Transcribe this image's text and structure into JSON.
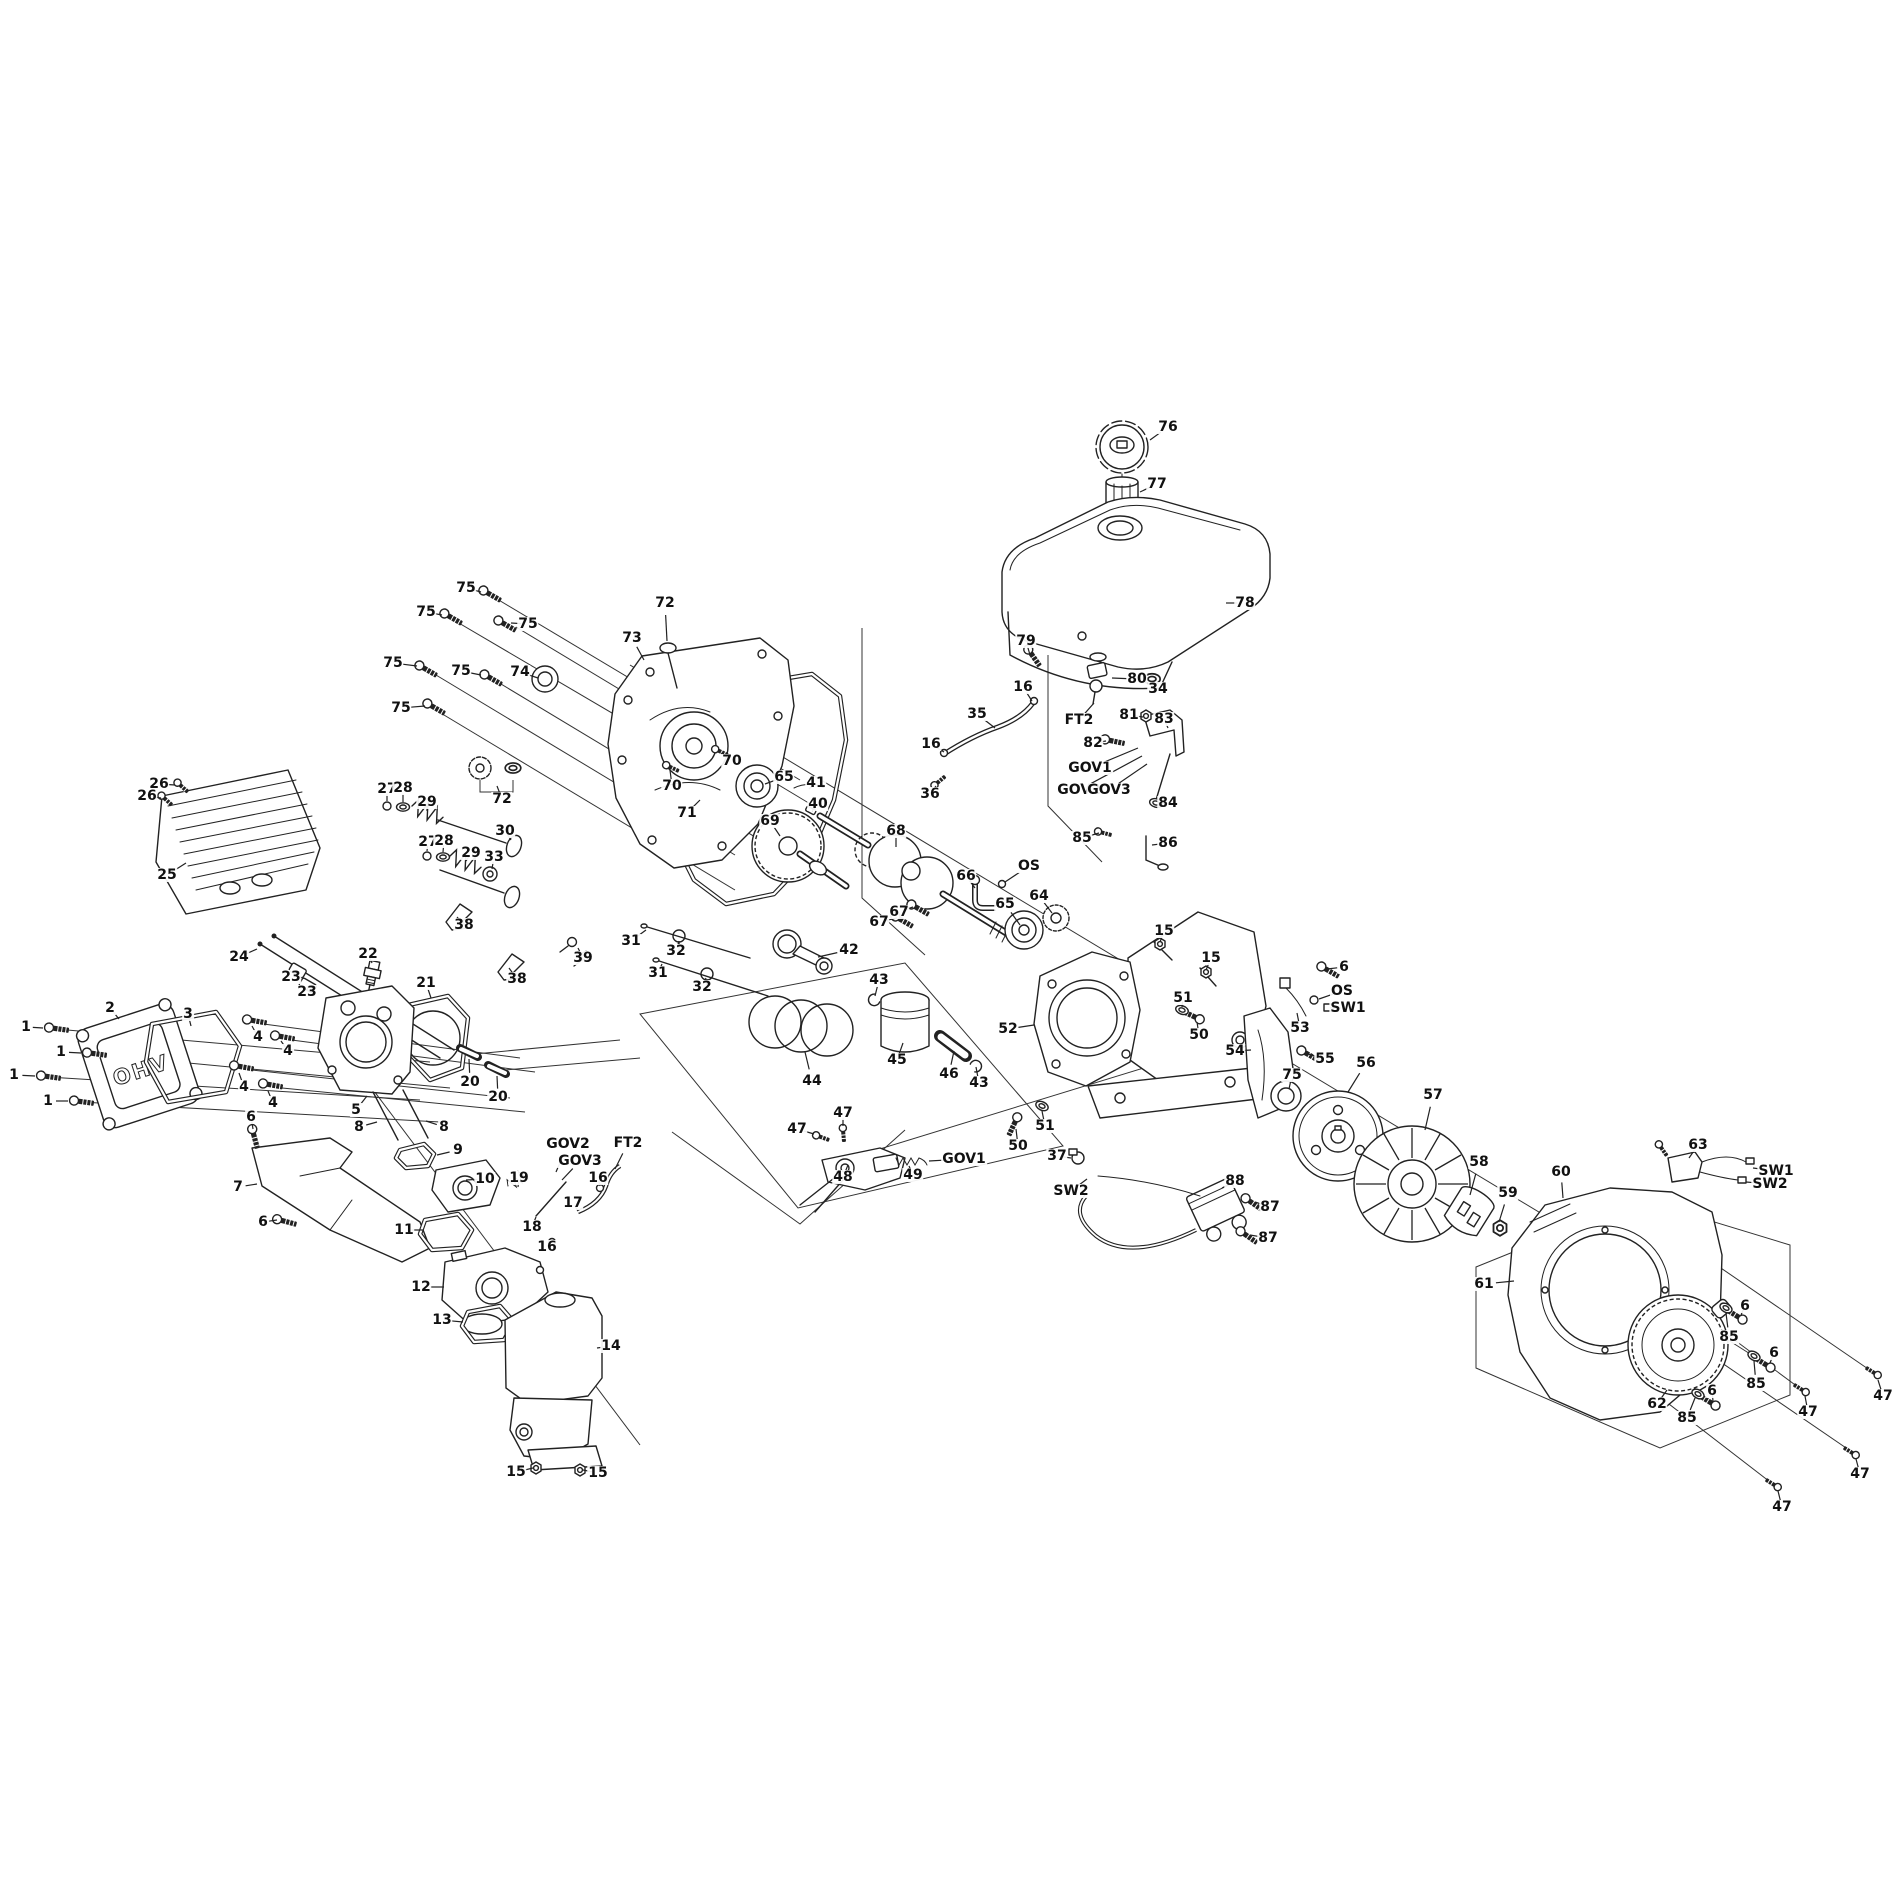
{
  "diagram": {
    "type": "exploded-parts-diagram",
    "subject": "small OHV engine",
    "background": "#ffffff",
    "line_color": "#222222",
    "ohv_text": "OHV",
    "callouts": [
      {
        "t": "76",
        "x": 1168,
        "y": 427,
        "u": 1150,
        "v": 440
      },
      {
        "t": "77",
        "x": 1157,
        "y": 484,
        "u": 1140,
        "v": 492
      },
      {
        "t": "78",
        "x": 1245,
        "y": 603,
        "u": 1226,
        "v": 603
      },
      {
        "t": "79",
        "x": 1026,
        "y": 641,
        "u": 1030,
        "v": 655
      },
      {
        "t": "16",
        "x": 1023,
        "y": 687,
        "u": 1032,
        "v": 701
      },
      {
        "t": "35",
        "x": 977,
        "y": 714,
        "u": 995,
        "v": 728
      },
      {
        "t": "16",
        "x": 931,
        "y": 744,
        "u": 944,
        "v": 752
      },
      {
        "t": "36",
        "x": 930,
        "y": 794,
        "u": 936,
        "v": 786
      },
      {
        "t": "80",
        "x": 1137,
        "y": 679,
        "u": 1112,
        "v": 678
      },
      {
        "t": "34",
        "x": 1158,
        "y": 689,
        "u": 1152,
        "v": 681
      },
      {
        "t": "FT2",
        "x": 1079,
        "y": 720,
        "u": 1094,
        "v": 703
      },
      {
        "t": "81",
        "x": 1129,
        "y": 715,
        "u": 1143,
        "v": 717
      },
      {
        "t": "83",
        "x": 1164,
        "y": 719,
        "u": 1168,
        "v": 728
      },
      {
        "t": "82",
        "x": 1093,
        "y": 743,
        "u": 1106,
        "v": 741
      },
      {
        "t": "GOV1",
        "x": 1090,
        "y": 768,
        "u": 1138,
        "v": 748
      },
      {
        "t": "GOV2",
        "x": 1079,
        "y": 790,
        "u": 1142,
        "v": 756
      },
      {
        "t": "GOV3",
        "x": 1109,
        "y": 790,
        "u": 1147,
        "v": 764
      },
      {
        "t": "84",
        "x": 1168,
        "y": 803,
        "u": 1159,
        "v": 803
      },
      {
        "t": "85",
        "x": 1082,
        "y": 838,
        "u": 1099,
        "v": 833
      },
      {
        "t": "86",
        "x": 1168,
        "y": 843,
        "u": 1152,
        "v": 845
      },
      {
        "t": "75",
        "x": 466,
        "y": 588,
        "u": 481,
        "v": 592
      },
      {
        "t": "75",
        "x": 426,
        "y": 612,
        "u": 442,
        "v": 615
      },
      {
        "t": "75",
        "x": 528,
        "y": 624,
        "u": 511,
        "v": 623
      },
      {
        "t": "75",
        "x": 393,
        "y": 663,
        "u": 417,
        "v": 666
      },
      {
        "t": "75",
        "x": 461,
        "y": 671,
        "u": 481,
        "v": 675
      },
      {
        "t": "75",
        "x": 401,
        "y": 708,
        "u": 425,
        "v": 706
      },
      {
        "t": "74",
        "x": 520,
        "y": 672,
        "u": 538,
        "v": 678
      },
      {
        "t": "72",
        "x": 665,
        "y": 603,
        "u": 667,
        "v": 641
      },
      {
        "t": "73",
        "x": 632,
        "y": 638,
        "u": 644,
        "v": 660
      },
      {
        "t": "70",
        "x": 732,
        "y": 761,
        "u": 721,
        "v": 753
      },
      {
        "t": "70",
        "x": 672,
        "y": 786,
        "u": 670,
        "v": 770
      },
      {
        "t": "71",
        "x": 687,
        "y": 813,
        "u": 700,
        "v": 800
      },
      {
        "t": "72",
        "x": 502,
        "y": 799,
        "u": 497,
        "v": 786
      },
      {
        "t": "65",
        "x": 784,
        "y": 777,
        "u": 765,
        "v": 784
      },
      {
        "t": "69",
        "x": 770,
        "y": 821,
        "u": 780,
        "v": 836
      },
      {
        "t": "41",
        "x": 816,
        "y": 783,
        "u": 809,
        "v": 789
      },
      {
        "t": "40",
        "x": 818,
        "y": 804,
        "u": 812,
        "v": 811
      },
      {
        "t": "68",
        "x": 896,
        "y": 831,
        "u": 896,
        "v": 847
      },
      {
        "t": "66",
        "x": 966,
        "y": 876,
        "u": 975,
        "v": 888
      },
      {
        "t": "OS",
        "x": 1029,
        "y": 866,
        "u": 1005,
        "v": 882
      },
      {
        "t": "67",
        "x": 899,
        "y": 912,
        "u": 913,
        "v": 907
      },
      {
        "t": "67",
        "x": 879,
        "y": 922,
        "u": 897,
        "v": 918
      },
      {
        "t": "65",
        "x": 1005,
        "y": 904,
        "u": 1020,
        "v": 925
      },
      {
        "t": "64",
        "x": 1039,
        "y": 896,
        "u": 1052,
        "v": 913
      },
      {
        "t": "31",
        "x": 631,
        "y": 941,
        "u": 646,
        "v": 930
      },
      {
        "t": "32",
        "x": 676,
        "y": 951,
        "u": 679,
        "v": 941
      },
      {
        "t": "31",
        "x": 658,
        "y": 973,
        "u": 662,
        "v": 964
      },
      {
        "t": "32",
        "x": 702,
        "y": 987,
        "u": 706,
        "v": 978
      },
      {
        "t": "42",
        "x": 849,
        "y": 950,
        "u": 818,
        "v": 957
      },
      {
        "t": "43",
        "x": 879,
        "y": 980,
        "u": 875,
        "v": 996
      },
      {
        "t": "44",
        "x": 812,
        "y": 1081,
        "u": 805,
        "v": 1052
      },
      {
        "t": "45",
        "x": 897,
        "y": 1060,
        "u": 903,
        "v": 1043
      },
      {
        "t": "46",
        "x": 949,
        "y": 1074,
        "u": 954,
        "v": 1051
      },
      {
        "t": "43",
        "x": 979,
        "y": 1083,
        "u": 976,
        "v": 1067
      },
      {
        "t": "52",
        "x": 1008,
        "y": 1029,
        "u": 1034,
        "v": 1025
      },
      {
        "t": "47",
        "x": 843,
        "y": 1113,
        "u": 843,
        "v": 1126
      },
      {
        "t": "47",
        "x": 797,
        "y": 1129,
        "u": 814,
        "v": 1134
      },
      {
        "t": "48",
        "x": 843,
        "y": 1177,
        "u": 848,
        "v": 1165
      },
      {
        "t": "49",
        "x": 913,
        "y": 1175,
        "u": 909,
        "v": 1166
      },
      {
        "t": "GOV1",
        "x": 964,
        "y": 1159,
        "u": 929,
        "v": 1161
      },
      {
        "t": "50",
        "x": 1018,
        "y": 1146,
        "u": 1016,
        "v": 1129
      },
      {
        "t": "51",
        "x": 1045,
        "y": 1126,
        "u": 1042,
        "v": 1111
      },
      {
        "t": "37",
        "x": 1057,
        "y": 1156,
        "u": 1071,
        "v": 1158
      },
      {
        "t": "SW2",
        "x": 1071,
        "y": 1191,
        "u": 1087,
        "v": 1179
      },
      {
        "t": "15",
        "x": 1164,
        "y": 931,
        "u": 1160,
        "v": 942
      },
      {
        "t": "15",
        "x": 1211,
        "y": 958,
        "u": 1206,
        "v": 970
      },
      {
        "t": "51",
        "x": 1183,
        "y": 998,
        "u": 1182,
        "v": 1007
      },
      {
        "t": "50",
        "x": 1199,
        "y": 1035,
        "u": 1197,
        "v": 1022
      },
      {
        "t": "6",
        "x": 1344,
        "y": 967,
        "u": 1327,
        "v": 969
      },
      {
        "t": "OS",
        "x": 1342,
        "y": 991,
        "u": 1319,
        "v": 999
      },
      {
        "t": "SW1",
        "x": 1348,
        "y": 1008,
        "u": 1330,
        "v": 1008
      },
      {
        "t": "53",
        "x": 1300,
        "y": 1028,
        "u": 1297,
        "v": 1013
      },
      {
        "t": "54",
        "x": 1235,
        "y": 1051,
        "u": 1251,
        "v": 1050
      },
      {
        "t": "55",
        "x": 1325,
        "y": 1059,
        "u": 1308,
        "v": 1054
      },
      {
        "t": "75",
        "x": 1292,
        "y": 1075,
        "u": 1289,
        "v": 1089
      },
      {
        "t": "56",
        "x": 1366,
        "y": 1063,
        "u": 1348,
        "v": 1092
      },
      {
        "t": "57",
        "x": 1433,
        "y": 1095,
        "u": 1425,
        "v": 1130
      },
      {
        "t": "58",
        "x": 1479,
        "y": 1162,
        "u": 1470,
        "v": 1195
      },
      {
        "t": "59",
        "x": 1508,
        "y": 1193,
        "u": 1499,
        "v": 1222
      },
      {
        "t": "60",
        "x": 1561,
        "y": 1172,
        "u": 1563,
        "v": 1198
      },
      {
        "t": "61",
        "x": 1484,
        "y": 1284,
        "u": 1514,
        "v": 1281
      },
      {
        "t": "62",
        "x": 1657,
        "y": 1404,
        "u": 1667,
        "v": 1390
      },
      {
        "t": "63",
        "x": 1698,
        "y": 1145,
        "u": 1689,
        "v": 1158
      },
      {
        "t": "SW1",
        "x": 1776,
        "y": 1171,
        "u": 1753,
        "v": 1168
      },
      {
        "t": "SW2",
        "x": 1770,
        "y": 1184,
        "u": 1746,
        "v": 1182
      },
      {
        "t": "6",
        "x": 1745,
        "y": 1306,
        "u": 1741,
        "v": 1315
      },
      {
        "t": "85",
        "x": 1729,
        "y": 1337,
        "u": 1726,
        "v": 1313
      },
      {
        "t": "6",
        "x": 1774,
        "y": 1353,
        "u": 1770,
        "v": 1363
      },
      {
        "t": "85",
        "x": 1756,
        "y": 1384,
        "u": 1754,
        "v": 1361
      },
      {
        "t": "6",
        "x": 1712,
        "y": 1391,
        "u": 1713,
        "v": 1401
      },
      {
        "t": "85",
        "x": 1687,
        "y": 1418,
        "u": 1695,
        "v": 1398
      },
      {
        "t": "47",
        "x": 1808,
        "y": 1412,
        "u": 1805,
        "v": 1396
      },
      {
        "t": "47",
        "x": 1883,
        "y": 1396,
        "u": 1878,
        "v": 1380
      },
      {
        "t": "47",
        "x": 1860,
        "y": 1474,
        "u": 1856,
        "v": 1459
      },
      {
        "t": "47",
        "x": 1782,
        "y": 1507,
        "u": 1778,
        "v": 1491
      },
      {
        "t": "88",
        "x": 1235,
        "y": 1181,
        "u": 1222,
        "v": 1188
      },
      {
        "t": "87",
        "x": 1270,
        "y": 1207,
        "u": 1255,
        "v": 1202
      },
      {
        "t": "87",
        "x": 1268,
        "y": 1238,
        "u": 1250,
        "v": 1235
      },
      {
        "t": "26",
        "x": 159,
        "y": 784,
        "u": 175,
        "v": 785
      },
      {
        "t": "26",
        "x": 147,
        "y": 796,
        "u": 161,
        "v": 798
      },
      {
        "t": "25",
        "x": 167,
        "y": 875,
        "u": 186,
        "v": 863
      },
      {
        "t": "27",
        "x": 387,
        "y": 789,
        "u": 387,
        "v": 801
      },
      {
        "t": "28",
        "x": 403,
        "y": 788,
        "u": 403,
        "v": 802
      },
      {
        "t": "29",
        "x": 427,
        "y": 802,
        "u": 427,
        "v": 811
      },
      {
        "t": "27",
        "x": 428,
        "y": 842,
        "u": 427,
        "v": 851
      },
      {
        "t": "28",
        "x": 444,
        "y": 841,
        "u": 443,
        "v": 852
      },
      {
        "t": "29",
        "x": 471,
        "y": 853,
        "u": 466,
        "v": 861
      },
      {
        "t": "30",
        "x": 505,
        "y": 831,
        "u": 511,
        "v": 840
      },
      {
        "t": "33",
        "x": 494,
        "y": 857,
        "u": 492,
        "v": 869
      },
      {
        "t": "24",
        "x": 239,
        "y": 957,
        "u": 257,
        "v": 949
      },
      {
        "t": "23",
        "x": 291,
        "y": 977,
        "u": 298,
        "v": 972
      },
      {
        "t": "23",
        "x": 307,
        "y": 992,
        "u": 308,
        "v": 986
      },
      {
        "t": "22",
        "x": 368,
        "y": 954,
        "u": 372,
        "v": 963
      },
      {
        "t": "21",
        "x": 426,
        "y": 983,
        "u": 431,
        "v": 998
      },
      {
        "t": "38",
        "x": 464,
        "y": 925,
        "u": 457,
        "v": 917
      },
      {
        "t": "38",
        "x": 517,
        "y": 979,
        "u": 509,
        "v": 968
      },
      {
        "t": "39",
        "x": 583,
        "y": 958,
        "u": 578,
        "v": 948
      },
      {
        "t": "2",
        "x": 110,
        "y": 1008,
        "u": 119,
        "v": 1019
      },
      {
        "t": "3",
        "x": 188,
        "y": 1014,
        "u": 191,
        "v": 1026
      },
      {
        "t": "1",
        "x": 26,
        "y": 1027,
        "u": 43,
        "v": 1028
      },
      {
        "t": "1",
        "x": 61,
        "y": 1052,
        "u": 81,
        "v": 1053
      },
      {
        "t": "1",
        "x": 14,
        "y": 1075,
        "u": 35,
        "v": 1076
      },
      {
        "t": "1",
        "x": 48,
        "y": 1101,
        "u": 68,
        "v": 1101
      },
      {
        "t": "4",
        "x": 258,
        "y": 1037,
        "u": 252,
        "v": 1026
      },
      {
        "t": "4",
        "x": 288,
        "y": 1051,
        "u": 281,
        "v": 1041
      },
      {
        "t": "4",
        "x": 244,
        "y": 1087,
        "u": 239,
        "v": 1073
      },
      {
        "t": "4",
        "x": 273,
        "y": 1103,
        "u": 268,
        "v": 1091
      },
      {
        "t": "5",
        "x": 356,
        "y": 1110,
        "u": 367,
        "v": 1096
      },
      {
        "t": "20",
        "x": 470,
        "y": 1082,
        "u": 469,
        "v": 1059
      },
      {
        "t": "20",
        "x": 498,
        "y": 1097,
        "u": 497,
        "v": 1076
      },
      {
        "t": "6",
        "x": 251,
        "y": 1117,
        "u": 253,
        "v": 1129
      },
      {
        "t": "7",
        "x": 238,
        "y": 1187,
        "u": 257,
        "v": 1184
      },
      {
        "t": "6",
        "x": 263,
        "y": 1222,
        "u": 277,
        "v": 1220
      },
      {
        "t": "8",
        "x": 359,
        "y": 1127,
        "u": 377,
        "v": 1122
      },
      {
        "t": "8",
        "x": 444,
        "y": 1127,
        "u": 426,
        "v": 1121
      },
      {
        "t": "9",
        "x": 458,
        "y": 1150,
        "u": 437,
        "v": 1155
      },
      {
        "t": "10",
        "x": 485,
        "y": 1179,
        "u": 466,
        "v": 1180
      },
      {
        "t": "11",
        "x": 404,
        "y": 1230,
        "u": 423,
        "v": 1230
      },
      {
        "t": "12",
        "x": 421,
        "y": 1287,
        "u": 444,
        "v": 1287
      },
      {
        "t": "13",
        "x": 442,
        "y": 1320,
        "u": 463,
        "v": 1322
      },
      {
        "t": "14",
        "x": 611,
        "y": 1346,
        "u": 597,
        "v": 1348
      },
      {
        "t": "15",
        "x": 516,
        "y": 1472,
        "u": 533,
        "v": 1468
      },
      {
        "t": "15",
        "x": 598,
        "y": 1473,
        "u": 583,
        "v": 1470
      },
      {
        "t": "GOV2",
        "x": 568,
        "y": 1144,
        "u": 556,
        "v": 1172
      },
      {
        "t": "GOV3",
        "x": 580,
        "y": 1161,
        "u": 562,
        "v": 1180
      },
      {
        "t": "FT2",
        "x": 628,
        "y": 1143,
        "u": 615,
        "v": 1169
      },
      {
        "t": "19",
        "x": 519,
        "y": 1178,
        "u": 518,
        "v": 1187
      },
      {
        "t": "16",
        "x": 598,
        "y": 1178,
        "u": 600,
        "v": 1186
      },
      {
        "t": "17",
        "x": 573,
        "y": 1203,
        "u": 578,
        "v": 1211
      },
      {
        "t": "18",
        "x": 532,
        "y": 1227,
        "u": 536,
        "v": 1217
      },
      {
        "t": "16",
        "x": 547,
        "y": 1247,
        "u": 552,
        "v": 1241
      }
    ]
  }
}
